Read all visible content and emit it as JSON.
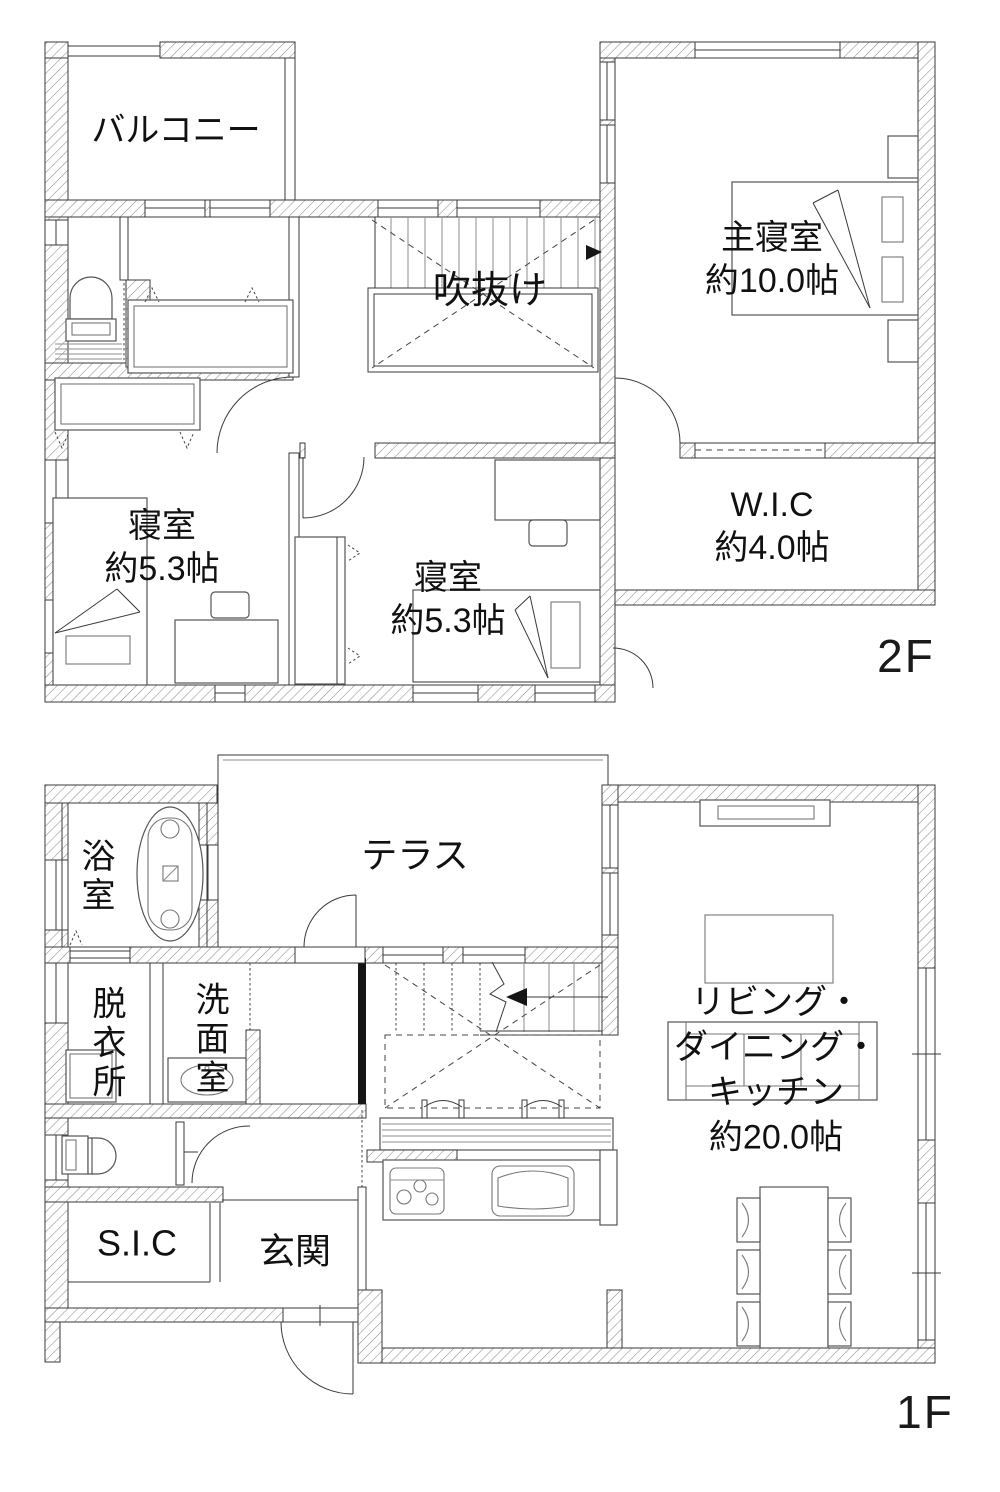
{
  "page": {
    "background": "#ffffff"
  },
  "colors": {
    "line": "#3a3a3a",
    "hatch": "#8d8d8d",
    "solid_wall": "#151515"
  },
  "floor2": {
    "floor_label": "2F",
    "rooms": {
      "balcony": {
        "label": "バルコニー"
      },
      "void": {
        "label": "吹抜け"
      },
      "master_bedroom": {
        "label": "主寝室\n約10.0帖"
      },
      "bedroom_left": {
        "label": "寝室\n約5.3帖"
      },
      "bedroom_center": {
        "label": "寝室\n約5.3帖"
      },
      "walk_in_closet": {
        "label": "W.I.C\n約4.0帖"
      }
    }
  },
  "floor1": {
    "floor_label": "1F",
    "rooms": {
      "bath": {
        "label": "浴室"
      },
      "terrace": {
        "label": "テラス"
      },
      "dressing_room": {
        "label": "脱衣所"
      },
      "washroom": {
        "label": "洗面室"
      },
      "shoe_closet": {
        "label": "S.I.C"
      },
      "entrance": {
        "label": "玄関"
      },
      "ldk": {
        "label": "リビング・\nダイニング・\nキッチン\n約20.0帖"
      }
    }
  }
}
